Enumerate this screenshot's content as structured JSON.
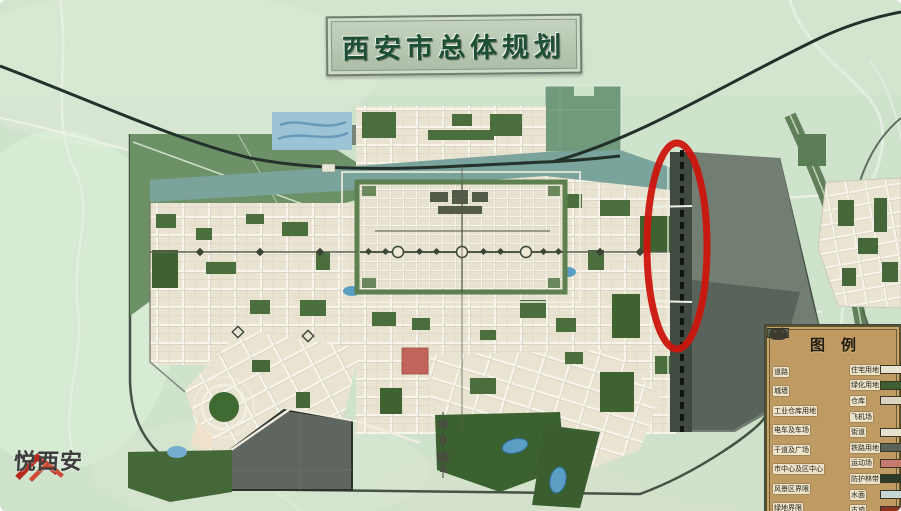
{
  "map": {
    "title": "西安市总体规划",
    "annotations": {
      "highlight_ellipse": {
        "shape": "ellipse",
        "color": "#cc150c",
        "location": "east-city-boundary"
      }
    }
  },
  "legend": {
    "title": "图例",
    "left_items": [
      {
        "label": "道路",
        "symbol": "road-fork"
      },
      {
        "label": "城墙",
        "symbol": "wall-line"
      },
      {
        "label": "工业仓库用地",
        "symbol": "dark-swatch"
      },
      {
        "label": "电车及车场",
        "symbol": "pole"
      },
      {
        "label": "干道及广场",
        "symbol": "star"
      },
      {
        "label": "市中心及区中心",
        "symbol": "crenellated-blob"
      },
      {
        "label": "风景区界限",
        "symbol": "outline-blob"
      },
      {
        "label": "绿地界限",
        "symbol": "outline-shape"
      }
    ],
    "right_items": [
      {
        "label": "住宅用地",
        "swatch": "#e8e3d2"
      },
      {
        "label": "绿化用地",
        "swatch": "#3c5e30"
      },
      {
        "label": "仓库",
        "swatch": "#d9d5c2"
      },
      {
        "label": "飞机场",
        "swatch": null
      },
      {
        "label": "街道",
        "swatch": "#e6e2d0"
      },
      {
        "label": "铁路用地",
        "swatch": "#5a635a"
      },
      {
        "label": "运动场",
        "swatch": "#c47a6c"
      },
      {
        "label": "防护林带",
        "swatch": "#2c3b27"
      },
      {
        "label": "水面",
        "swatch": "#c5d6d6"
      },
      {
        "label": "古迹",
        "swatch": "#8a3426"
      }
    ]
  },
  "watermark": {
    "text": "悦西安",
    "logo": "roof-icon",
    "logo_color": "#b5291c"
  },
  "colors": {
    "countryside": "#cfe2cc",
    "city_blocks": "#e9e3d1",
    "park_green": "#3f6231",
    "zone_green": "#6d9166",
    "rail_corridor": "#7aa39b",
    "railway": "#23312a",
    "gray_zone": "#727e72",
    "water": "#7fb5cf",
    "highlight": "#cc150c",
    "historic_red": "#c2635c",
    "legend_bg": "#bf9a62",
    "plaque_text": "#1d4f33"
  }
}
